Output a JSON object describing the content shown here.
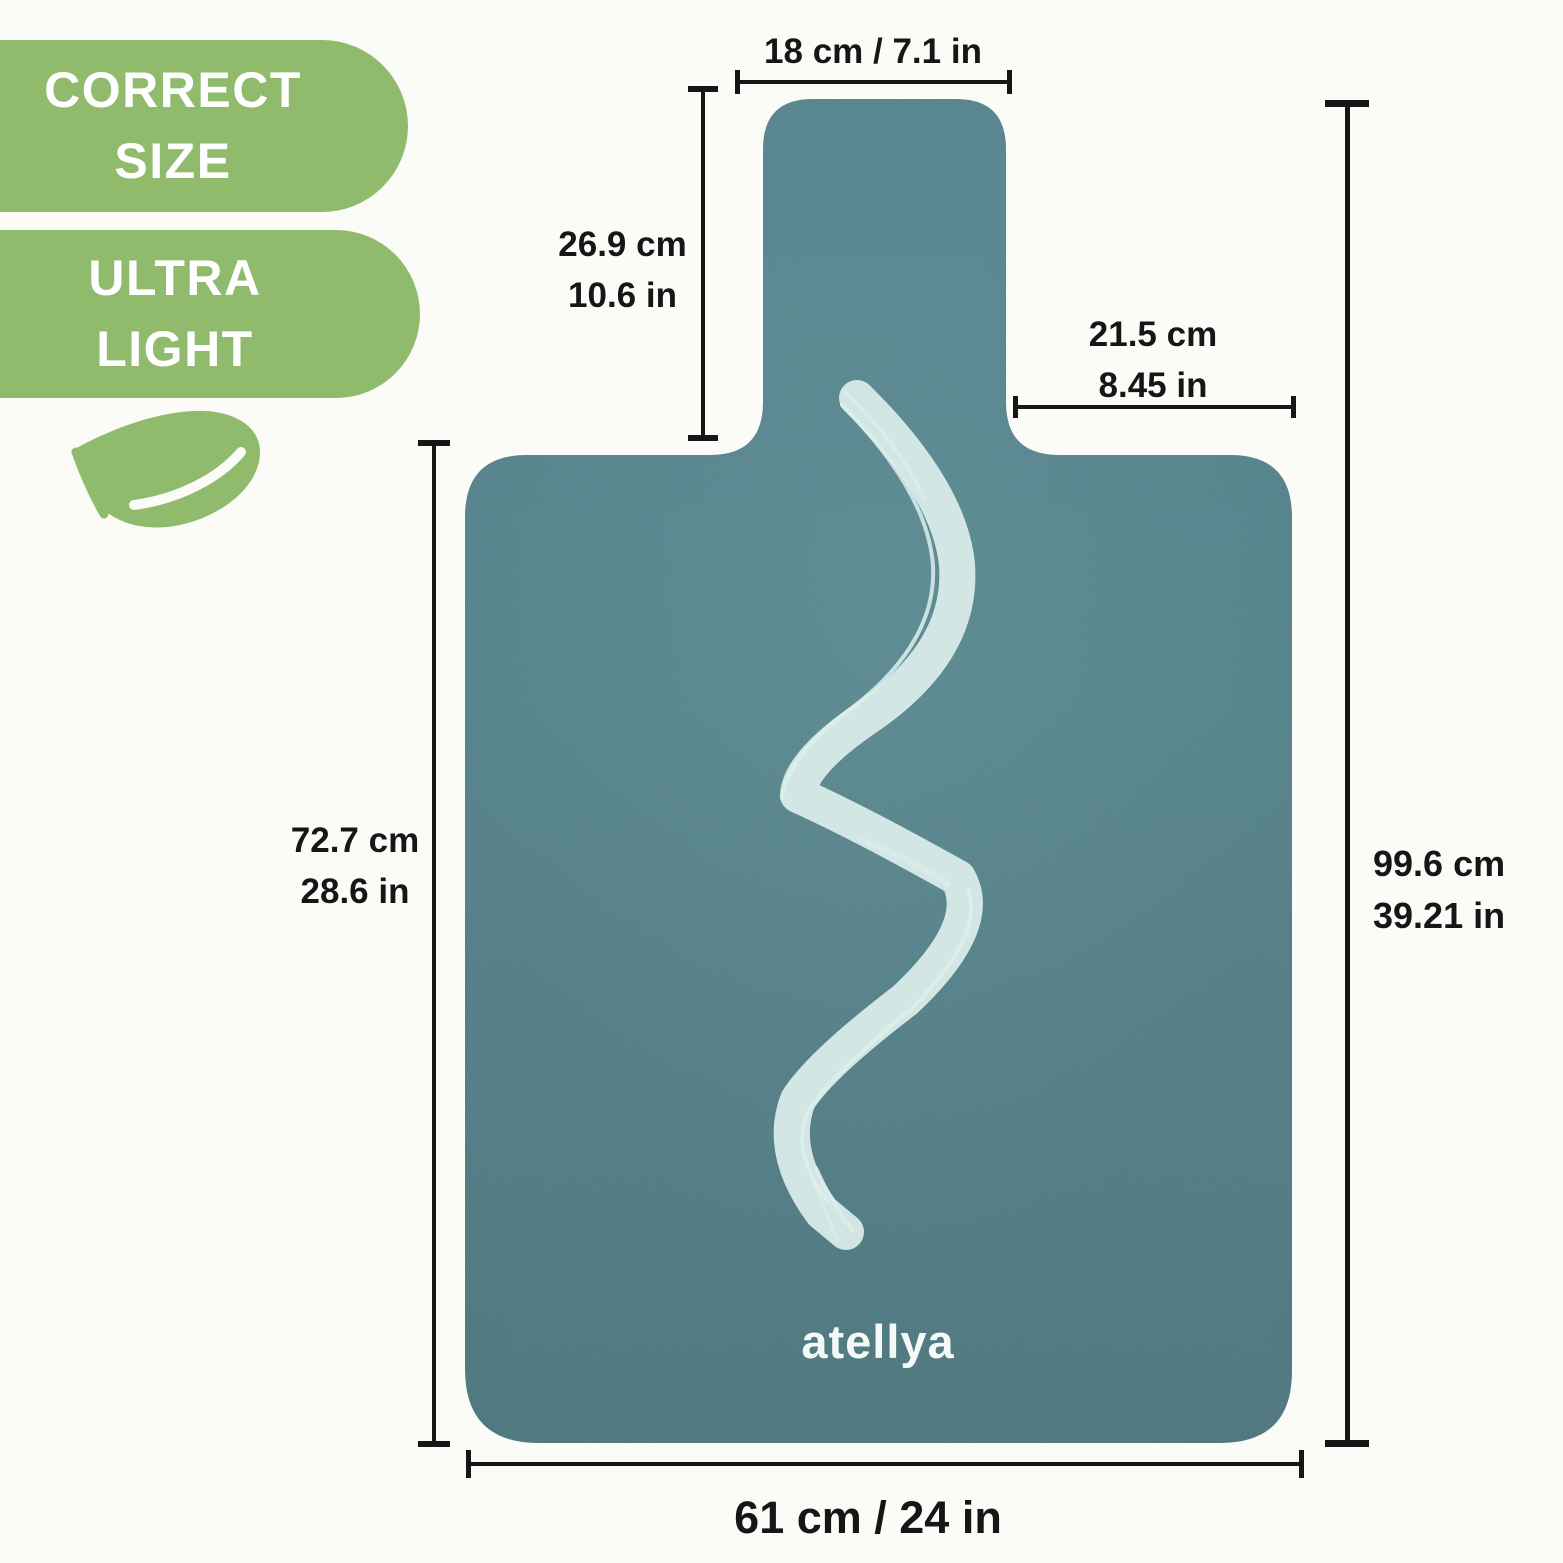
{
  "badges": [
    {
      "line1": "CORRECT",
      "line2": "SIZE"
    },
    {
      "line1": "ULTRA",
      "line2": "LIGHT"
    }
  ],
  "icons": {
    "feather": "feather-icon"
  },
  "brand": {
    "logo_text": "atellya"
  },
  "dimensions": {
    "handle_width": {
      "label": "18 cm / 7.1 in"
    },
    "handle_height": {
      "cm": "26.9 cm",
      "in": "10.6 in"
    },
    "shoulder_width": {
      "cm": "21.5 cm",
      "in": "8.45 in"
    },
    "body_height": {
      "cm": "72.7 cm",
      "in": "28.6 in"
    },
    "total_height": {
      "cm": "99.6 cm",
      "in": "39.21 in"
    },
    "total_width": {
      "label": "61 cm / 24 in"
    }
  },
  "colors": {
    "badge_green": "#90bb6c",
    "mat_teal": "#4e7b85",
    "brush_stroke": "#dcefeb",
    "dimension_text": "#161616",
    "background": "#fbfbf8"
  }
}
